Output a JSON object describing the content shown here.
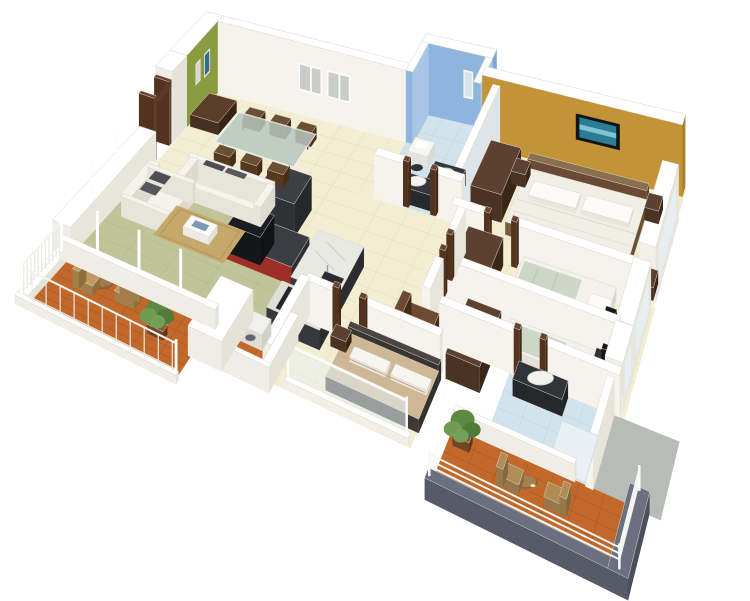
{
  "meta": {
    "title": "3D isometric floor plan rendering - 3 bedroom apartment with two balconies",
    "background": "#ffffff"
  },
  "palette": {
    "wall_top": "#ffffff",
    "wall_face": "#f5f3ec",
    "wall_face_nw": "#efede6",
    "wall_shade": "#e7e4da",
    "wall_dark_edge": "#d9d6cc",
    "floor_cream": "#f3eed3",
    "tile_line": "#e2dbb9",
    "living_olive": "#bfc599",
    "olive_line": "#aab387",
    "blue_wall": "#8fb4de",
    "blue_wall_light": "#a9c6e6",
    "blue_wall_deep": "#7ea6d0",
    "bath_floor": "#d3e3ee",
    "bath_line": "#b7cfdf",
    "green_wall": "#8a9b40",
    "yellow_wall": "#c39338",
    "yellow_shade": "#a87f2c",
    "terracotta": "#c2682a",
    "terracotta_line": "#94491b",
    "wood_dark": "#4a3322",
    "wood_mid": "#5d4130",
    "wood_light": "#8a6f4e",
    "charcoal": "#34373c",
    "charcoal_dark": "#26282c",
    "red_cabinet": "#9e2f27",
    "sofa_white": "#f5f3ec",
    "cushion_gray": "#4e4e52",
    "rug_tan": "#c5a96c",
    "bed_tan": "#cdb795",
    "blanket_green": "#ccd7c7",
    "gray_floor": "#b8bbb6",
    "slate": "#565b68",
    "plant_green": "#5d8a43",
    "glass": "#e7eef2",
    "basin_white": "#f2f2ee",
    "tv_screen": "#2b7d94",
    "art_blue": "#2f6e8e"
  },
  "rooms": {
    "living_dining": "living & dining room",
    "kitchen": "kitchen",
    "bathroom1": "main bathroom",
    "master_bedroom": "master bedroom",
    "kid_bedroom_1": "bedroom 2",
    "kid_bedroom_2": "bedroom 3",
    "bathroom2": "second bathroom",
    "bedroom3": "guest bedroom",
    "balcony_left": "left balcony",
    "balcony_service": "service balcony",
    "balcony_right": "right balcony"
  }
}
